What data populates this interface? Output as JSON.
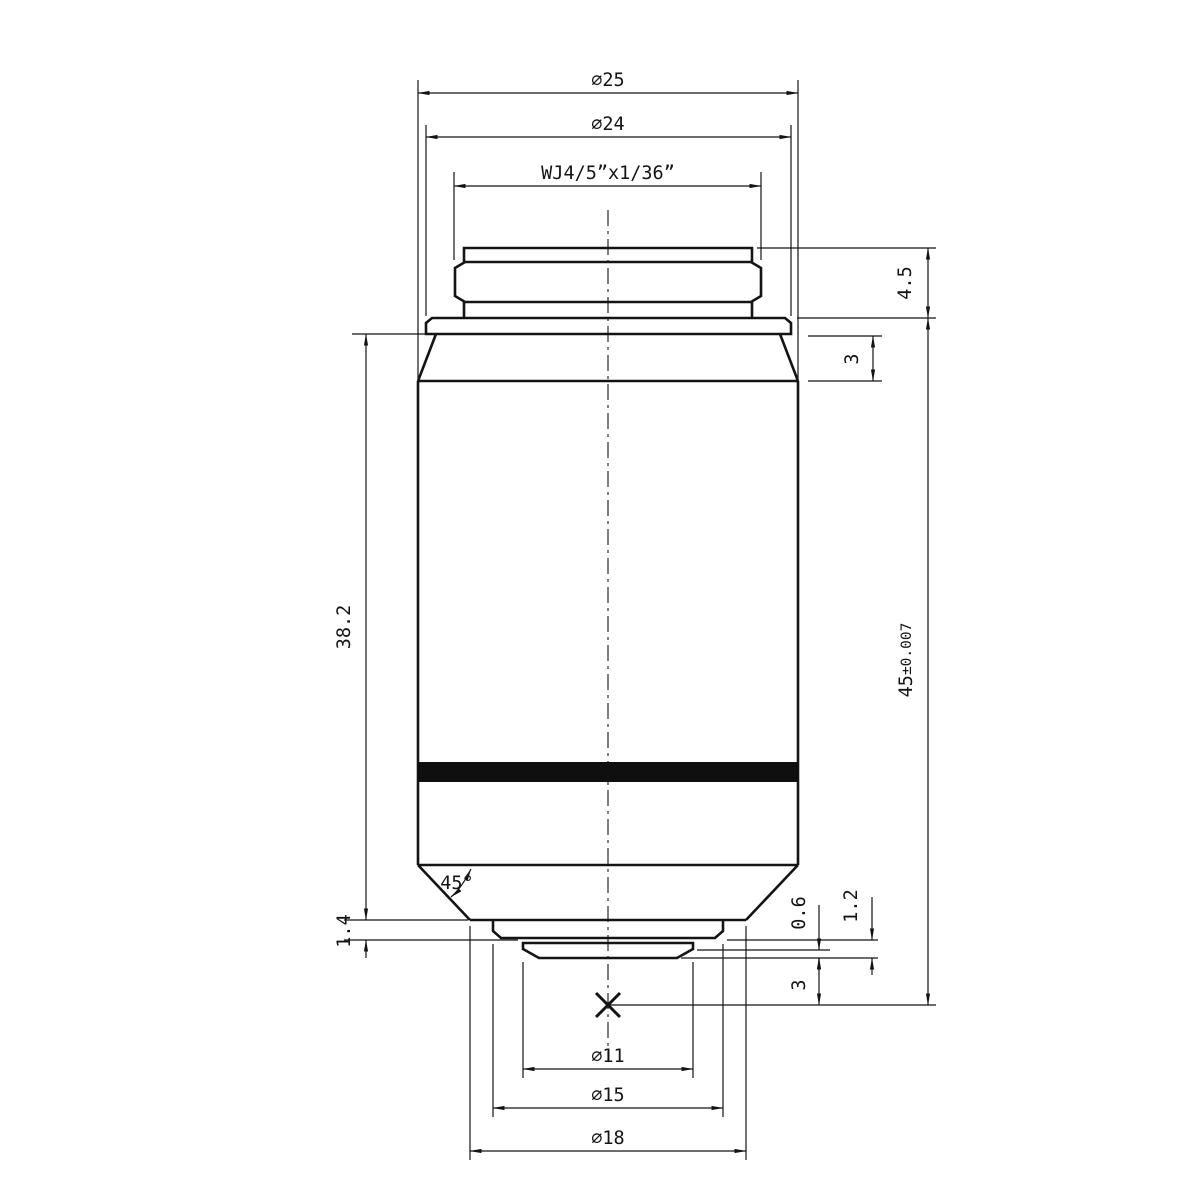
{
  "drawing": {
    "subject": "microscope-objective-dimension-drawing",
    "colors": {
      "ink": "#141414",
      "background": "#ffffff",
      "knurl_band": "#0f0f0f"
    },
    "labels": {
      "outer_diameter": "⌀25",
      "flange_diameter": "⌀24",
      "mount_thread": "WJ4/5”x1/36”",
      "thread_height": "4.5",
      "collar_taper_height": "3",
      "body_length": "38.2",
      "parfocal_main": "45",
      "parfocal_tolerance": "±0.007",
      "chamfer_angle": "45°",
      "nose_step": "1.4",
      "front_recess": "0.6",
      "front_step": "1.2",
      "working_distance": "3",
      "front_lens_diameter": "⌀11",
      "retainer_diameter": "⌀15",
      "nose_diameter": "⌀18"
    }
  }
}
